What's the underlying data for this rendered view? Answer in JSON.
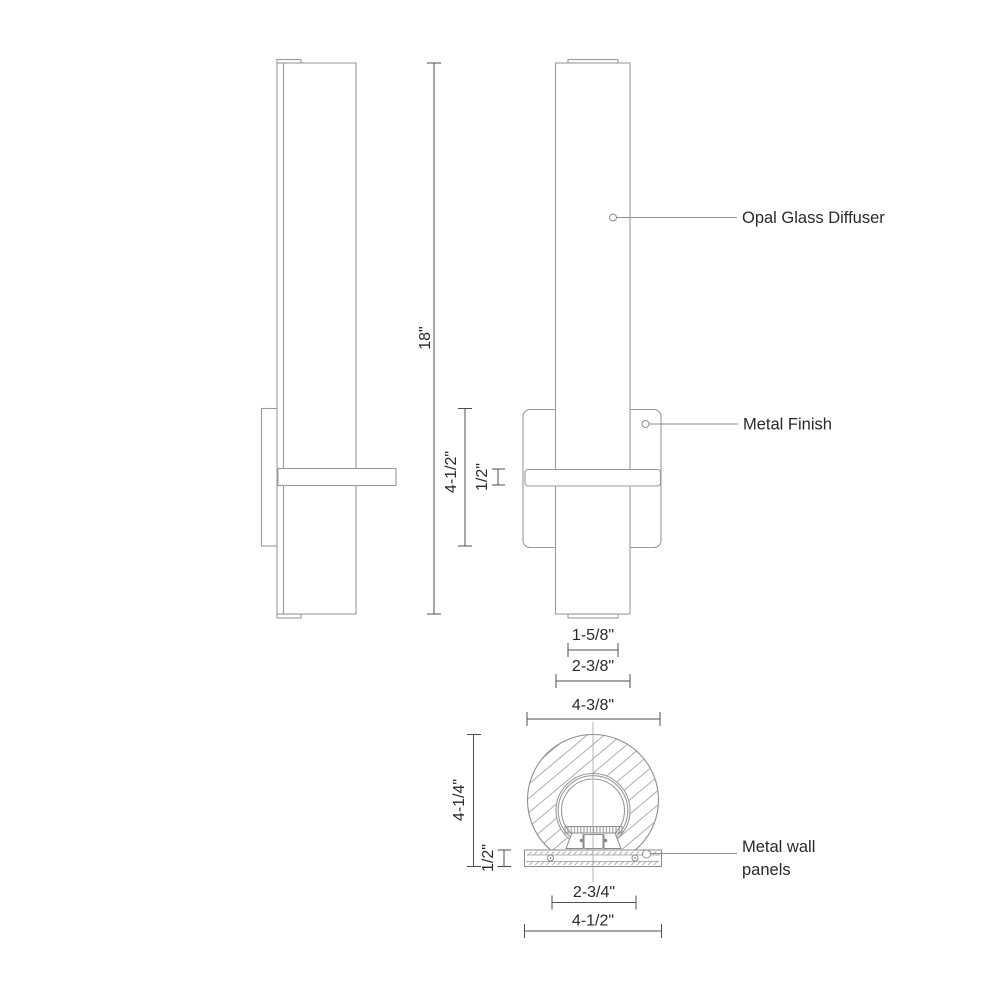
{
  "drawing": {
    "type": "wall-sconce-dimension-drawing",
    "annotations": {
      "diffuser_label": "Opal Glass Diffuser",
      "finish_label": "Metal Finish",
      "panels_label_line1": "Metal wall",
      "panels_label_line2": "panels"
    },
    "dimensions": {
      "fixture_height": "18\"",
      "backplate_height": "4-1/2\"",
      "arm_thickness": "1/2\"",
      "endcap_width": "1-5/8\"",
      "tube_width": "2-3/8\"",
      "body_diameter": "4-3/8\"",
      "overall_depth": "4-1/4\"",
      "plate_thickness": "1/2\"",
      "inner_mount_width": "2-3/4\"",
      "plate_width": "4-1/2\""
    },
    "style": {
      "outline_color": "#9b9b9b",
      "dimension_color": "#4f4f4f",
      "text_color": "#2a2a2a",
      "background_color": "#ffffff"
    }
  }
}
